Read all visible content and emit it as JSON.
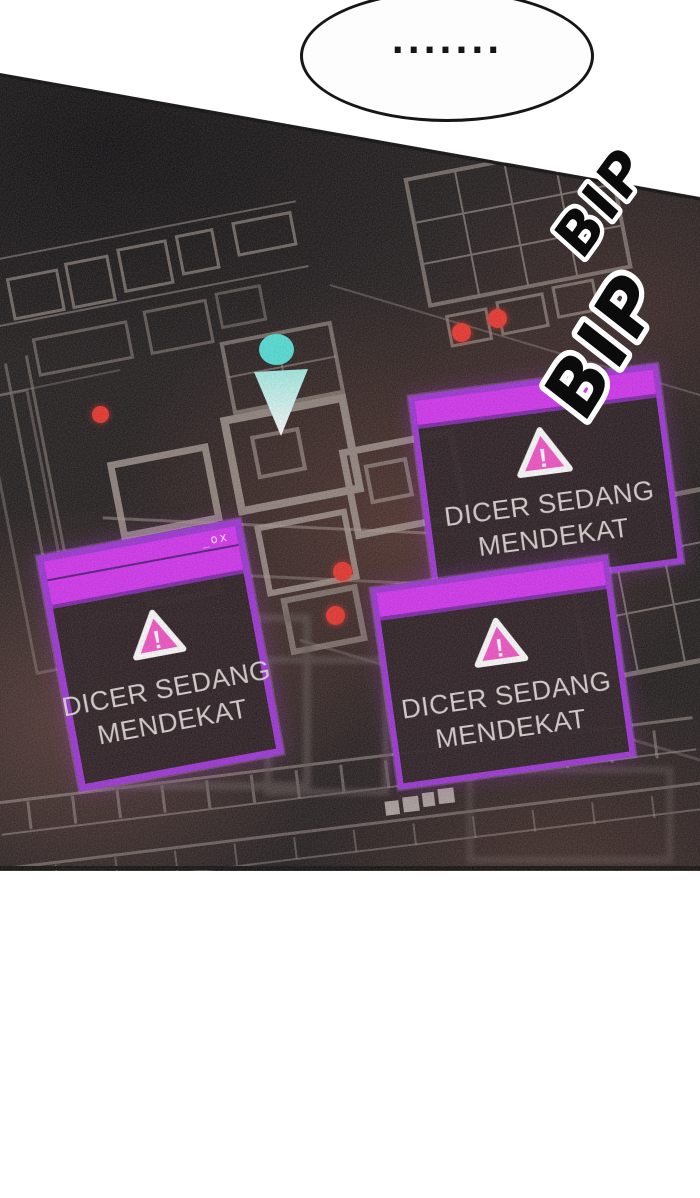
{
  "speech_bubble": {
    "text": "......."
  },
  "sound_effects": [
    {
      "text": "BIP"
    },
    {
      "text": "BIP"
    }
  ],
  "minimap": {
    "enemy_dot_count": 5,
    "alerts": [
      {
        "position": "top-right",
        "controls": "",
        "icon": "warning-triangle",
        "icon_mark": "!",
        "line1": "DICER SEDANG",
        "line2": "MENDEKAT"
      },
      {
        "position": "bottom-left",
        "controls": "_ox",
        "icon": "warning-triangle",
        "icon_mark": "!",
        "line1": "DICER SEDANG",
        "line2": "MENDEKAT"
      },
      {
        "position": "bottom-right",
        "controls": "",
        "icon": "warning-triangle",
        "icon_mark": "!",
        "line1": "DICER SEDANG",
        "line2": "MENDEKAT"
      }
    ]
  },
  "colors": {
    "alert_titlebar": "#d32ff2",
    "alert_border": "#9c2fd6",
    "warning_pink": "#f44fc6",
    "enemy_red": "#ea2f28",
    "player_cyan": "#4fe1d9",
    "map_base": "#1c1718"
  }
}
